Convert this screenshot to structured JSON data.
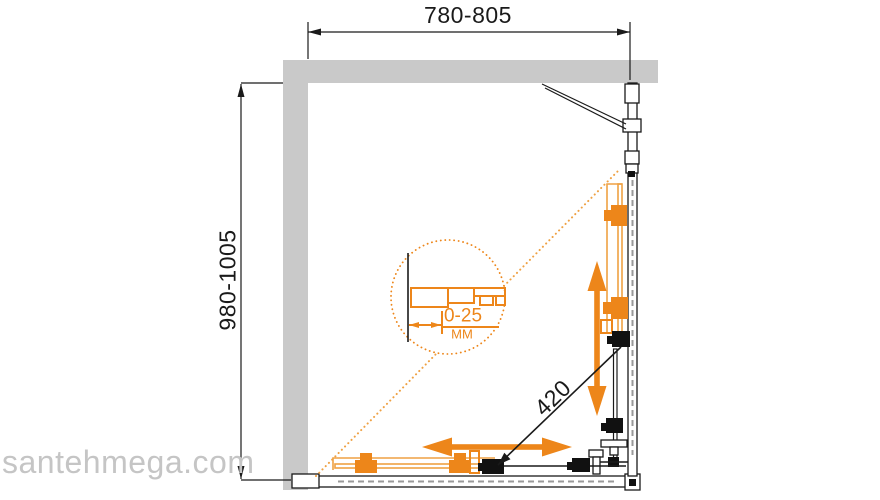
{
  "colors": {
    "accent": "#ed861a",
    "accent_light": "#efa143",
    "wall": "#c9c9c9",
    "line": "#1a1a1a",
    "watermark": "#c5c5c5"
  },
  "dimensions": {
    "width_range": {
      "label": "780-805"
    },
    "depth_range": {
      "label": "980-1005"
    },
    "door_opening": {
      "label": "420"
    },
    "wall_profile_adjustment": {
      "value": "0-25",
      "unit": "мм"
    }
  },
  "watermark": {
    "text": "santehmega.com"
  }
}
